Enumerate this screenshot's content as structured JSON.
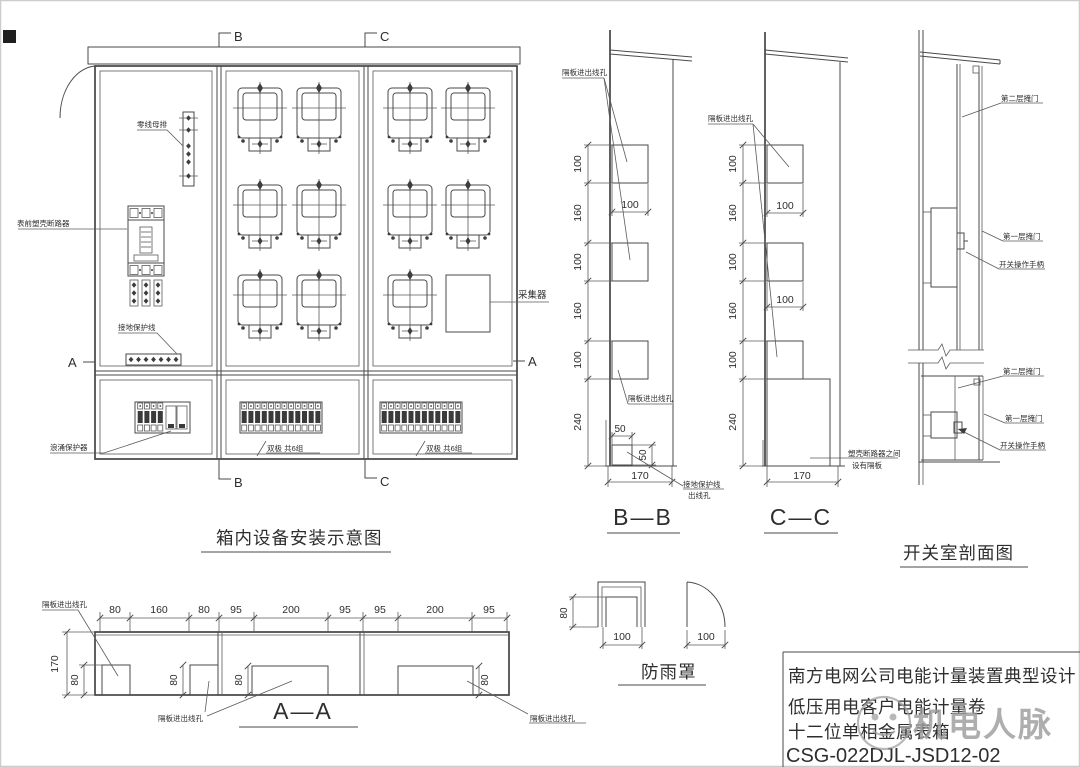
{
  "main_view": {
    "title": "箱内设备安装示意图",
    "markers": {
      "top_b": "B",
      "top_c": "C",
      "bottom_b": "B",
      "bottom_c": "C",
      "left_a": "A",
      "right_a": "A"
    },
    "labels": {
      "neutral_bus": "零线母排",
      "mccb": "表前塑壳断路器",
      "ground_wire": "接地保护线",
      "surge": "浪涌保护器",
      "collector": "采集器",
      "breakers_mid": "双极 共6组",
      "breakers_right": "双极 共6组"
    }
  },
  "section_bb": {
    "title": "B—B",
    "label_top": "隔板进出线孔",
    "label_mid": "隔板进出线孔",
    "label_bottom_1": "接地保护线",
    "label_bottom_2": "出线孔",
    "dims_v": [
      "100",
      "160",
      "100",
      "160",
      "100",
      "240"
    ],
    "dim_w": "100",
    "dim_50h": "50",
    "dim_50v": "50",
    "dim_base": "170"
  },
  "section_cc": {
    "title": "C—C",
    "label_top": "隔板进出线孔",
    "note_1": "塑壳断路器之间",
    "note_2": "设有隔板",
    "dims_v": [
      "100",
      "160",
      "100",
      "160",
      "100",
      "240"
    ],
    "dim_w1": "100",
    "dim_w2": "100",
    "dim_base": "170"
  },
  "switch_room": {
    "title": "开关室剖面图",
    "labels": {
      "door2_top": "第二层掩门",
      "door1_top": "第一层掩门",
      "handle_top": "开关操作手柄",
      "door2_bot": "第二层掩门",
      "door1_bot": "第一层掩门",
      "handle_bot": "开关操作手柄"
    }
  },
  "section_aa": {
    "title": "A—A",
    "top_dims": [
      "80",
      "160",
      "80",
      "95",
      "200",
      "95",
      "95",
      "200",
      "95"
    ],
    "dim_height": "170",
    "dim_hole_left": "80",
    "inner_dims": [
      "80",
      "80",
      "80"
    ],
    "label_top": "隔板进出线孔",
    "label_bottom": "隔板进出线孔",
    "label_bottom_right": "隔板进出线孔"
  },
  "rain_cover": {
    "title": "防雨罩",
    "dim_h": "80",
    "dim_w_left": "100",
    "dim_w_right": "100"
  },
  "title_block": {
    "line1": "南方电网公司电能计量装置典型设计",
    "line2": "低压用电客户电能计量卷",
    "line3": "十二位单相金属表箱",
    "line4": "CSG-022DJL-JSD12-02"
  },
  "watermark": {
    "text": "机电人脉"
  }
}
